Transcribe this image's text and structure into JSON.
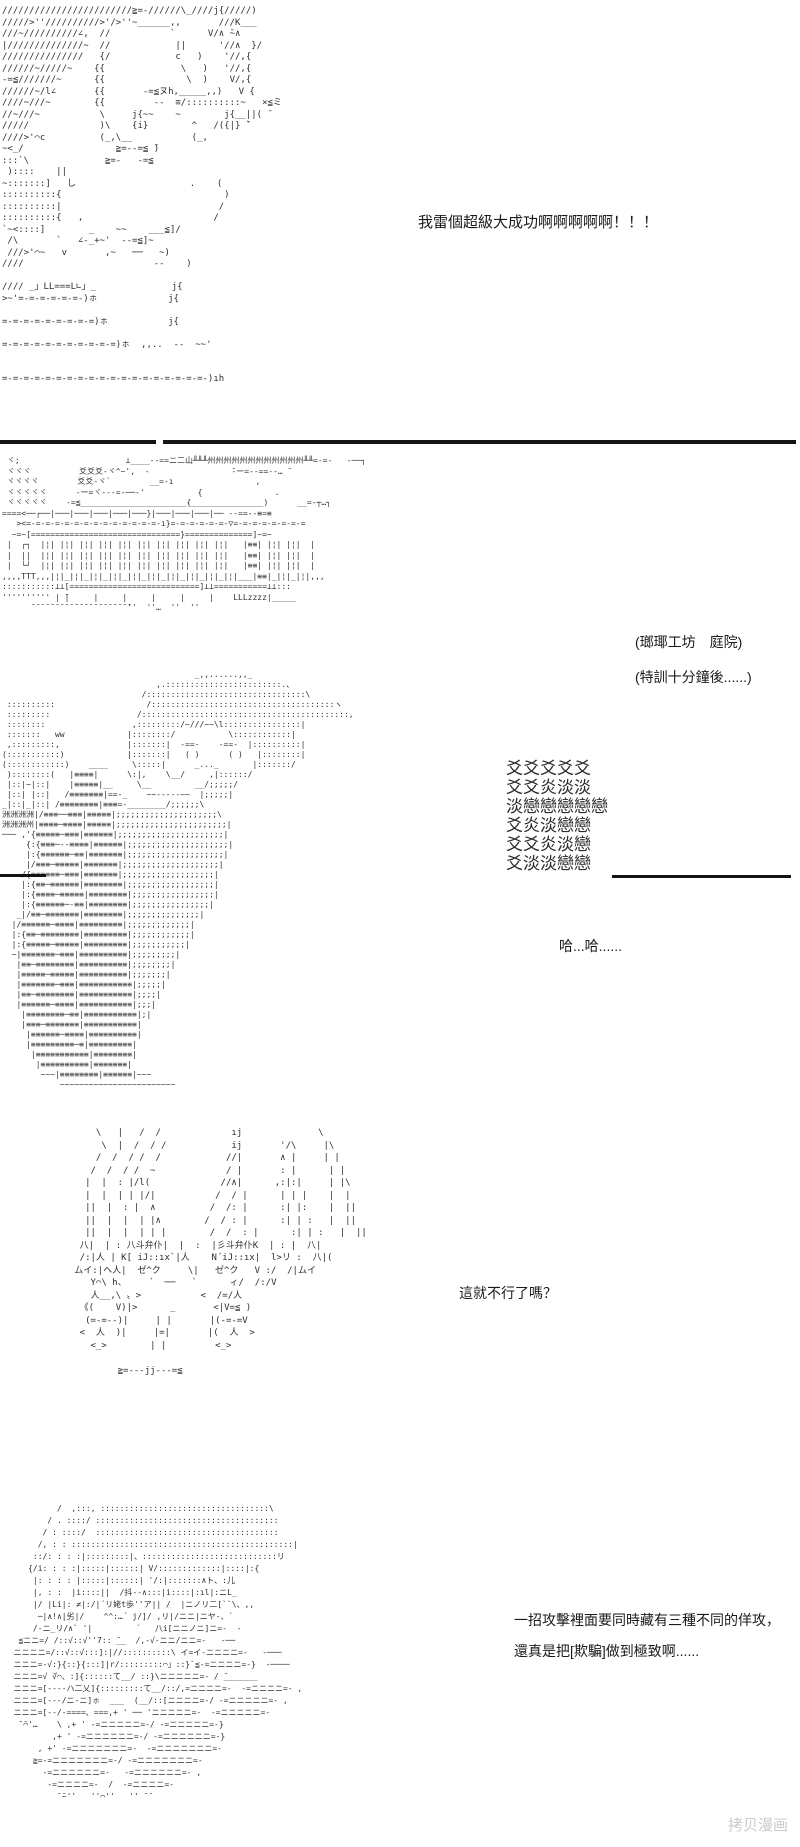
{
  "page": {
    "background": "#ffffff",
    "art_color": "#2e2e2e",
    "text_color": "#1a1a1a",
    "divider_color": "#141414",
    "watermark_color": "#cbcbcb"
  },
  "texts": {
    "shout": "我雷個超級大成功啊啊啊啊啊！！！",
    "scene_line1": "(瑯瑘工坊　庭院)",
    "scene_line2": "(特訓十分鐘後......)",
    "laugh": "哈...哈......",
    "question": "這就不行了嗎？",
    "monologue_line1": "一招攻擊裡面要同時藏有三種不同的佯攻，",
    "monologue_line2": "還真是把[欺騙]做到極致啊......",
    "watermark": "拷贝漫画"
  },
  "ascii": {
    "panel1_celebration": [
      "////////////////////////≧=-//////\\_////j{/////)",
      "/////>''//////////>'/>''~______,,       ///K___",
      "///~//////////∠,  //           `      V/∧ ̄~∧",
      "|//////////////~  //            ||      '//∧  }/",
      "///////////////   {/            c   )    '//,{",
      "//////~/////~    {{              \\   )   '//,{",
      "-=≦///////~      {{               \\  )    V/,{",
      "//////~/l∠       {{       -=≦ヌh,_____,,)   V {",
      "////~///~        {{         --  ≡/::::::::::~   ×≦ミ",
      "//~///~           \\     j{~~    ~        j{__||( ̄",
      "/////             )\\    {i}        ^   /({|} ̄`",
      "////>'⌒c          (_,\\__           (_,",
      "~<_/                 ≧=--=≦ ̄)",
      ":::`\\              ≧=-   -=≦",
      " )::::    ||",
      "~:::::::]   し                     .    (",
      "::::::::::{                              )",
      "::::::::::|                             /",
      "::::::::::{   ,                        /",
      "`~<::::]        _    ~~    ___≦]/",
      " /\\       `   ∠-_+~'  --=≦]~",
      " ///>'⌒~   v       ,~   ──   ~)",
      "////                        --    )",
      "",
      "//// _」LL===L∟」_              j{",
      ">~'=-=-=-=-=-=-)ㇹ             j{",
      "",
      "=-=-=-=-=-=-=-=-=)ㇹ           j{",
      "",
      "=-=-=-=-=-=-=-=-=-=-=)ㇹ  ,,..  --  ~~'",
      "",
      "",
      "=-=-=-=-=-=-=-=-=-=-=-=-=-=-=-=-=-=-=-)ıh",
      ""
    ],
    "panel2_workshop": [
      " ヾ;                      ⊥____--==ニ二山╨╨╨州州州州州州州州州州州州╨╨=-=-   -──┐",
      " ヾヾヾ          爻爻爻-ヾ^~',  -                 ̄‐ー=--==‐‐… ̄",
      " ヾヾヾヾ        爻爻-ヾ`        __=-ı                 ,",
      " ヾヾヾヾヾ      -ー=ヾ‐--=-──-'           {               .",
      " ヾヾヾヾヾ    -=≦______________________{_______________)      __=-┬…┐",
      "====<──┌──|───|───|───|───|───}|───|───|───|── --==--≡=≡",
      "   ><=-=-=-=-=-=-=-=-=-=-=-=-=-=-ı}=-=-=-=-=-=-▽=-=-=-=-=-=-=-=",
      "  ~=~[===============================}==============]~=~",
      " |  ┌┐  |¦| |¦| |¦| |¦| |¦| |¦| |¦| |¦| |¦| |¦|   |≡≡| |¦| |¦|  |",
      " |  ||  |¦| |¦| |¦| |¦| |¦| |¦| |¦| |¦| |¦| |¦|   |≡≡| |¦| |¦|  |",
      " |  └┘  |¦| |¦| |¦| |¦| |¦| |¦| |¦| |¦| |¦| |¦|   |≡≡| |¦| |¦|  |",
      ",,,,TTT,,,|¦|_|¦|_|¦|_|¦|_|¦|_|¦|_|¦|_|¦|_|¦|_|¦|___|≡≡|_|¦|_|¦|,,,",
      ":::::::::::⊥⊥[===========================]⊥⊥===========⊥⊥:::",
      "'''''''''' | ̄|     |     |     |     |     |    LLLzzzz|_____",
      "      ̄ ̄ ̄ ̄ ̄ ̄ ̄ ̄ ̄ ̄ ̄ ̄ ̄ ̄ ̄ ̄ ̄ ̄ ̄ ̄ ̄''  ''…  ''  ''",
      "",
      "",
      "",
      "",
      ""
    ],
    "panel3_training": [
      "                                        _,,......,,_",
      "                                ,.::::::::::::::::::::::::.、",
      "                             /:::::::::::::::::::::::::::::::::\\",
      " ::::::::::                   /::::::::::::::::::::::::::::::::::::::ヽ",
      " :::::::::                  /:::::::::::::::::::::::::::::::::::::::::::,",
      " ::::::::                  ,:::::::::/~///~~\\l::::::::::::::::|",
      " :::::::   ww             |::::::::/           \\::::::::::::|",
      " ,:::::::::,              |:::::::|  -==-    -==-  |::::::::::|",
      "(:::::::::::)             |:::::::|   ( )      ( )   |::::::::|",
      "(::::::::::::)    ____     \\:::::|      _..._       |:::::::/",
      " )::::::::(   |≡≡≡≡|      \\:|,    \\__/     ,|::::::/",
      " |::|~|::|    |≡≡≡≡≡|__     \\__         __/;;;;;/",
      " |::| |::|   /≡≡≡≡≡≡≡|==-_    ~~-----~~  |;;;;;|",
      "_|::|_|::| /≡≡≡≡≡≡≡≡|≡≡≡=-________/;;;;;;\\",
      "洲洲洲洲|/≡≡≡──≡≡≡|≡≡≡≡≡|;;;;;;;;;;;;;;;;;;;;;\\",
      "洲洲洲州|≡≡≡≡─≡≡≡≡|≡≡≡≡≡|;;;;;;;;;;;;;;;;;;;;;;;|",
      "──~ ,'{≡≡≡≡≡─≡≡≡|≡≡≡≡≡≡|;;;;;;;;;;;;;;;;;;;;;;|",
      "     {:{≡≡≡─--≡≡≡≡|≡≡≡≡≡≡|;;;;;;;;;;;;;;;;;;;;;|",
      "     |:{≡≡≡≡≡≡─≡≡|≡≡≡≡≡≡≡|;;;;;;;;;;;;;;;;;;;;|",
      "     |/≡≡≡─≡≡≡≡≡|≡≡≡≡≡≡≡|;;;;;;;;;;;;;;;;;;;;|",
      "    /{≡≡≡≡≡≡─≡≡≡|≡≡≡≡≡≡≡|;;;;;;;;;;;;;;;;;;;|",
      "    |:{≡≡─≡≡≡≡≡≡|≡≡≡≡≡≡≡≡|;;;;;;;;;;;;;;;;;;|",
      "    |:{≡≡≡≡─≡≡≡≡≡|≡≡≡≡≡≡≡≡|;;;;;;;;;;;;;;;;;|",
      "    |:{≡≡≡≡≡≡─-≡≡|≡≡≡≡≡≡≡≡|;;;;;;;;;;;;;;;;|",
      "   _|/≡≡─≡≡≡≡≡≡≡|≡≡≡≡≡≡≡≡|;;;;;;;;;;;;;;;|",
      "  |/≡≡≡≡≡≡─≡≡≡≡|≡≡≡≡≡≡≡≡≡|;;;;;;;;;;;;;|",
      "  |:{≡≡─≡≡≡≡≡≡≡≡|≡≡≡≡≡≡≡≡≡|;;;;;;;;;;;;|",
      "  |:{≡≡≡≡≡─≡≡≡≡≡|≡≡≡≡≡≡≡≡≡|;;;;;;;;;;;|",
      "  ~|≡≡≡≡≡≡≡─≡≡≡|≡≡≡≡≡≡≡≡≡≡|;;;;;;;;;|",
      "   |≡≡─≡≡≡≡≡≡≡≡|≡≡≡≡≡≡≡≡≡≡|;;;;;;;;|",
      "   |≡≡≡≡≡─≡≡≡≡≡|≡≡≡≡≡≡≡≡≡≡|;;;;;;;|",
      "   |≡≡≡≡≡≡≡─≡≡≡|≡≡≡≡≡≡≡≡≡≡≡|;;;;;|",
      "   |≡≡─≡≡≡≡≡≡≡≡|≡≡≡≡≡≡≡≡≡≡≡|;;;;|",
      "   |≡≡≡≡≡≡─≡≡≡≡|≡≡≡≡≡≡≡≡≡≡≡|;;;|",
      "    |≡≡≡≡≡≡≡≡─≡≡|≡≡≡≡≡≡≡≡≡≡≡|;|",
      "    |≡≡≡─≡≡≡≡≡≡≡|≡≡≡≡≡≡≡≡≡≡≡|",
      "     |≡≡≡≡≡≡─≡≡≡≡|≡≡≡≡≡≡≡≡≡≡|",
      "     |≡≡≡≡≡≡≡≡≡─≡|≡≡≡≡≡≡≡≡≡|",
      "      |≡≡≡≡≡≡≡≡≡≡≡|≡≡≡≡≡≡≡≡|",
      "       |≡≡≡≡≡≡≡≡≡≡|≡≡≡≡≡≡≡|",
      "        ~~~|≡≡≡≡≡≡≡≡|≡≡≡≡≡≡|~~~",
      "            ~~~~~~~~~~~~~~~~~~~~~~~~"
    ],
    "panel3_effect": [
      "爻爻爻爻爻",
      "爻爻炎淡淡",
      "淡戀戀戀戀戀",
      "爻炎淡戀戀",
      "爻爻炎淡戀",
      "爻淡淡戀戀"
    ],
    "panel4_face": [
      "       \\   |   /  /             ıj              \\",
      "        \\  |  /  / /            ij       '/\\     |\\",
      "       /  /  / /  /            //|       ∧ |     | |",
      "      /  /  / /  ~             / |       : |      | |",
      "     |  |  : |/l(             //∧|      ,:|:|     | |\\",
      "     |  |  | | |/|           /  / |      | | |    |  |",
      "     ||  |  : |  ∧          /  /: |      :| |:    |  ||",
      "     ||  |  |  | |∧        /  / : |      :| | :   |  ||",
      "     ||  |  |  | | |        /  /  : |      :| | :   |  ||",
      "    八|  | : 八斗弁仆|  |  :  |彡斗弁仆K  | : |  八|",
      "    /:|人 | K[ iJ::ıx`|人    N´iJ::ıx|  l>リ :  八|(",
      "   ムイ:|ヘ人|  ゼ^ク     \\|   ゼ^ク   V :/  /|ムイ",
      "      Y⌒\\ h、    ´  ──   `      ィ/  /:/V",
      "      人__,\\ 〟>           <  /=/人",
      "    《(    V)|>      _       <|V=≦ )",
      "     (=-=--)|     | |       |(-=-=V",
      "    <  人  )|     |=|       |(  人  >",
      "      <_>        | |         <_>",
      "",
      "           ≧=---jj---=≦"
    ],
    "panel5_closeup": [
      "           /  ,:::, :::::::::::::::::::::::::::::::::::\\",
      "         / . ::::/ ::::::::::::::::::::::::::::::::::::::",
      "        / : ::::/  ::::::::::::::::::::::::::::::::::::::",
      "       /, : : ::::::::::::::::::::::::::::::::::::::::::::::|",
      "      ::/: : : :|:::::::::|、::::::::::::::::::::::::::::リ",
      "     {/i: : : :|:::::|::::::| V/:::::::::::::|::::|:{",
      "      |: : : : |:::::|::::::| '/:|:::::::∧ト、:儿",
      "      |, : :  |i::::||  /抖-‐∧:::|i::::|:ıl|:ニL_",
      "      |/ |Li|: ≠|:/|´リ姥t歩''ア|| /  |ニノリ二[``\\、,,",
      "       ─|∧!∧|劣|/    ^^:…´ j/]/ ,リ|/ニニ|ニヤ-、`",
      "      /-ニ_リ/∧` '|         ´   八i[ニニノニ]ニ=-  -",
      "   ≦ニニ=/ /::√::√''7:: ̄__  /,-√-ニニ/ニニ=-   -──",
      "  ニニニニ=/::√::√:::]:|//::::::::::\\ イ=イ-ニニニニ=-   -───",
      "  ニニニ=-√:}{::}{:::]|r/:::::::::⌒」::}`≦-=ニニニニ=-}  -────",
      "  ニニニ=√ ̄√⌒、:]{::::::て__/ ::}\\ニニニニニ=- / ̄_______",
      "  ニニニ=[----ハ二乂]{:::::::::て__/::/,=ニニニニ=-  -=ニニニニ=- ,",
      "  ニニニ=[---/ニ-ニ]ㇹ  ___  (__/::[ニニニニ=-/ -=ニニニニニ=- ,",
      "  ニニニ=[--/-====、===,+ ' ── 'ニニニニニ=-  -=ニニニニニ=-",
      "   ̄ ̄⌒'…    \\ ,+ ' -=ニニニニニ=-/ -=ニニニニニ=-}",
      "          ,+ ' -=ニニニニニニ=-/ -=ニニニニニニ=-}",
      "       , +' -=ニニニニニニニ=-  -=ニニニニニニニ=-",
      "      ≧=-=ニニニニニニニ=-/ -=ニニニニニニニ=-",
      "        -=ニニニニニニ=-   -=ニニニニニニ=- ,",
      "         -=ニニニニ=-  /  -=ニニニニ=-",
      "           ̄ ̄~''   ''⌒''   '' ̄ ̄"
    ]
  }
}
